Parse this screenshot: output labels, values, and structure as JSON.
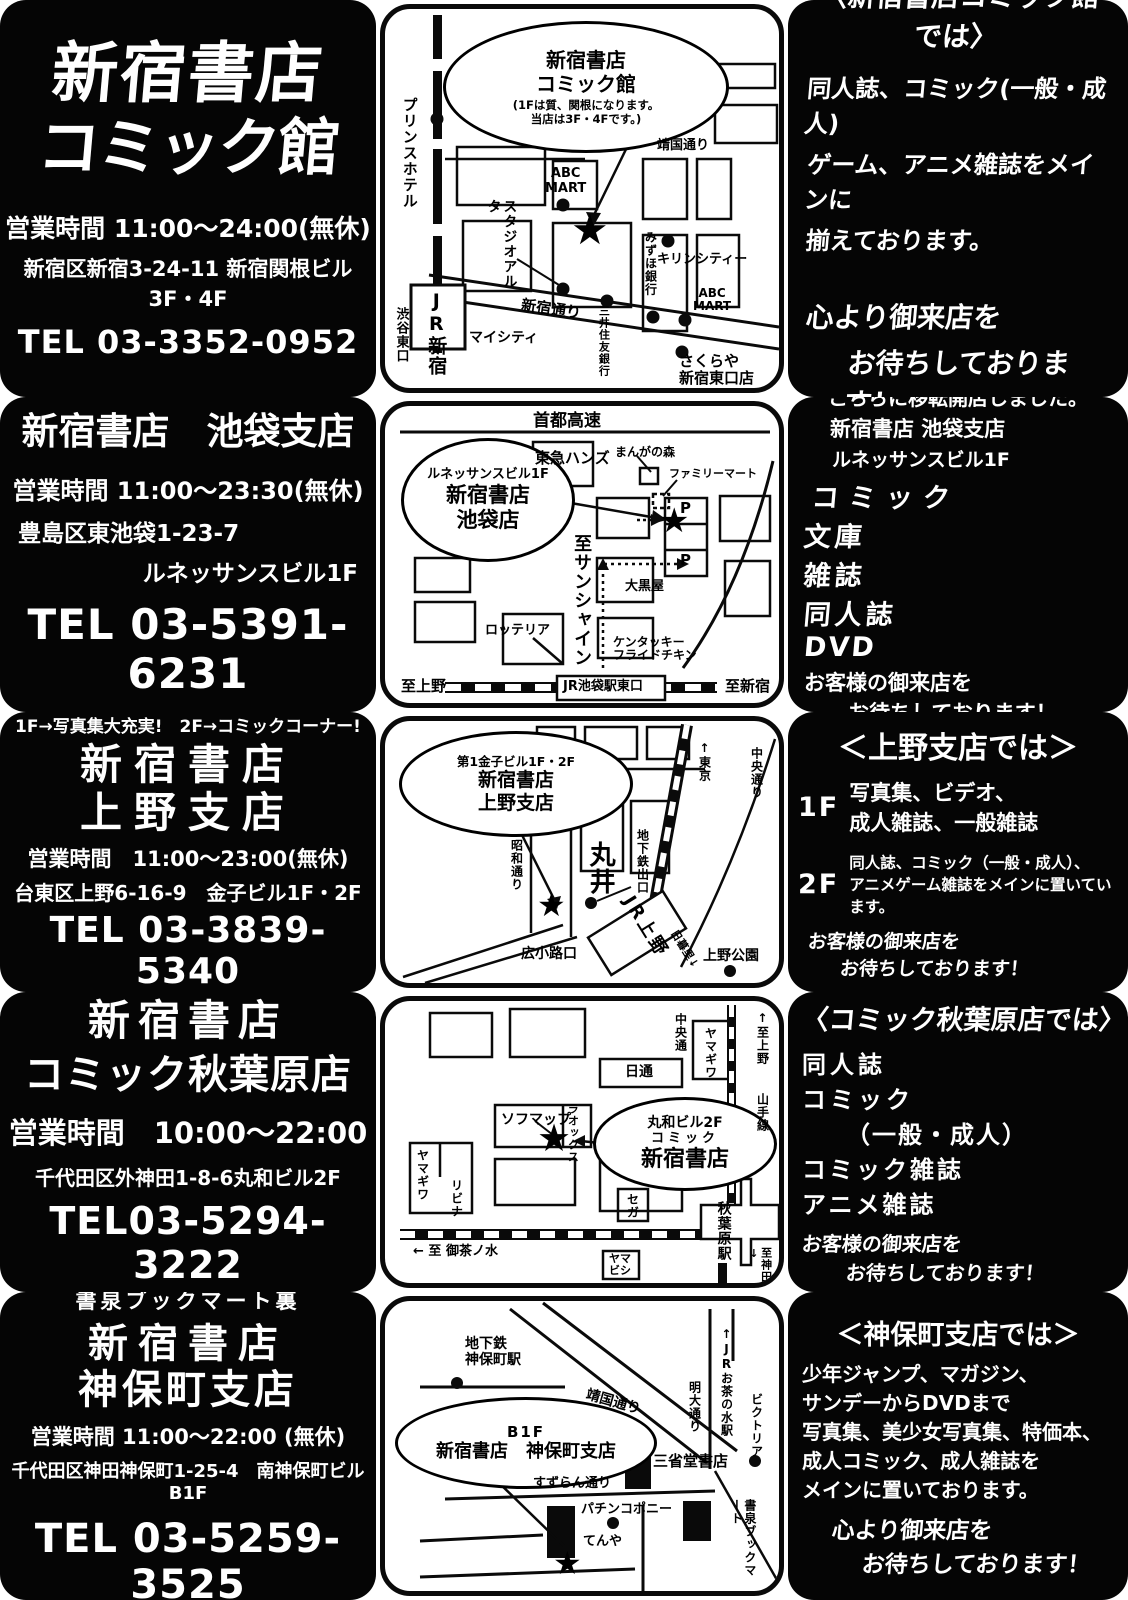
{
  "rows": [
    {
      "store": {
        "line1": "新宿書店",
        "line2": "コミック館",
        "hours": "営業時間 11:00〜24:00(無休)",
        "addr1": "新宿区新宿3-24-11 新宿関根ビル3F・4F",
        "tel": "TEL 03-3352-0952"
      },
      "map": {
        "balloon1": "新宿書店",
        "balloon2": "コミック館",
        "balloon3": "(1Fは質、関根になります。",
        "balloon4": "当店は3F・4Fです。)",
        "prince_hotel": "プリンスホテル",
        "jr_shinjuku": "JR新宿",
        "shibuya_east": "渋谷東口",
        "mycity": "マイシティ",
        "studio_alta": "スタジオアルタ",
        "abc_mart1": "ABC\nMART",
        "shinjuku_dori": "新宿通り",
        "mitsui_sumitomo": "三井住友銀行",
        "mizuho": "みずほ銀行",
        "kirin_city": "キリンシティー",
        "abc_mart2": "ABC\nMART",
        "sakuraya": "さくらや\n新宿東口店",
        "yasukuni_dori": "靖国通り",
        "star": "★"
      },
      "info": {
        "heading": "〈新宿書店コミック館では〉",
        "body1": "同人誌、コミック(一般・成人)",
        "body2": "ゲーム、アニメ雑誌をメインに",
        "body3": "揃えております。",
        "close1": "心より御来店を",
        "close2": "お待ちしております！"
      }
    },
    {
      "store": {
        "line1": "新宿書店　池袋支店",
        "hours": "営業時間 11:00〜23:30(無休)",
        "addr1": "豊島区東池袋1-23-7",
        "addr2": "ルネッサンスビル1F",
        "tel": "TEL 03-5391-6231"
      },
      "map": {
        "shuto": "首都高速",
        "tokyu_hands": "東急ハンズ",
        "manga_mori": "まんがの森",
        "familymart": "ファミリーマート",
        "p_top": "P",
        "p_bottom": "P",
        "balloon1": "ルネッサンスビル1F",
        "balloon2": "新宿書店",
        "balloon3": "池袋店",
        "sunshine": "至サンシャイン",
        "daikokuya": "大黒屋",
        "lotteria": "ロッテリア",
        "kfc": "ケンタッキー\nフライドチキン",
        "to_ueno": "至上野",
        "station": "JR池袋駅東口",
        "to_shinjuku": "至新宿",
        "star": "★"
      },
      "info": {
        "intro1": "こちらに移転開店しました。",
        "intro2": "新宿書店 池袋支店",
        "intro3": "ルネッサンスビル1F",
        "item1": "コミック",
        "item2": "文庫",
        "item3": "雑誌",
        "item4": "同人誌",
        "item5": "DVD",
        "close1": "お客様の御来店を",
        "close2": "お待ちしております！"
      }
    },
    {
      "store": {
        "top": "1F→写真集大充実!　2F→コミックコーナー!",
        "line1": "新宿書店",
        "line2": "上野支店",
        "hours": "営業時間　11:00〜23:00(無休)",
        "addr1": "台東区上野6-16-9　金子ビル1F・2F",
        "tel": "TEL 03-3839-5340"
      },
      "map": {
        "balloon1": "第1金子ビル1F・2F",
        "balloon2": "新宿書店",
        "balloon3": "上野支店",
        "showa_dori": "昭和通り",
        "marui": "丸井",
        "subway_exit": "地下鉄出口",
        "to_tokyo": "↑東京",
        "chuo_dori": "中央通り",
        "hirokoji": "広小路口",
        "jr_ueno": "JR上野",
        "nippori": "日暮里↓",
        "ueno_park": "上野公園",
        "star": "★"
      },
      "info": {
        "heading": "＜上野支店では＞",
        "floor1_label": "1F",
        "floor1_line1": "写真集、ビデオ、",
        "floor1_line2": "成人雑誌、一般雑誌",
        "floor2_label": "2F",
        "floor2_line1": "同人誌、コミック（一般・成人）、",
        "floor2_line2": "アニメゲーム雑誌をメインに置いています。",
        "close1": "お客様の御来店を",
        "close2": "お待ちしております！"
      }
    },
    {
      "store": {
        "line1": "新宿書店",
        "line2": "コミック秋葉原店",
        "hours": "営業時間　10:00〜22:00",
        "addr1": "千代田区外神田1-8-6丸和ビル2F",
        "tel": "TEL03-5294-3222"
      },
      "map": {
        "chuo_dori": "中央通",
        "yamagiwa1": "ヤマギワ",
        "to_ueno": "↑至上野",
        "yamanote": "山手線",
        "nittsu": "日通",
        "sofmap": "ソフマップ",
        "laox": "ラオックス",
        "balloon1": "丸和ビル2F",
        "balloon2": "コミック",
        "balloon3": "新宿書店",
        "yamagiwa2": "ヤマギワ",
        "livina": "リビナ",
        "sega": "セガ",
        "station": "秋葉原駅",
        "ochanomizu": "← 至 御茶ノ水",
        "yamabishi": "ヤマ\nビシ",
        "to_kanda": "至神田↓",
        "star": "★"
      },
      "info": {
        "heading": "〈コミック秋葉原店では〉",
        "body1": "同人誌",
        "body2": "コミック",
        "body3": "（一般・成人）",
        "body4": "コミック雑誌",
        "body5": "アニメ雑誌",
        "close1": "お客様の御来店を",
        "close2": "お待ちしております！"
      }
    },
    {
      "store": {
        "top": "書泉ブックマート裏",
        "line1": "新宿書店",
        "line2": "神保町支店",
        "hours": "営業時間 11:00〜22:00 (無休)",
        "addr1": "千代田区神田神保町1-25-4　南神保町ビルB1F",
        "tel": "TEL 03-5259-3525"
      },
      "map": {
        "subway": "地下鉄\n神保町駅",
        "yasukuni": "靖国通り",
        "balloon1": "B1F",
        "balloon2": "新宿書店　神保町支店",
        "suzuran": "すずらん通り",
        "pachinko": "パチンコポニー",
        "tenya": "てんや",
        "sanseido": "三省堂書店",
        "meidai": "明大通り",
        "jr_ochanomizu": "↑JRお茶の水駅",
        "victoria": "ビクトリア",
        "shosen": "書泉ブックマート",
        "star": "★"
      },
      "info": {
        "heading": "＜神保町支店では＞",
        "body1": "少年ジャンプ、マガジン、",
        "body2": "サンデーからDVDまで",
        "body3": "写真集、美少女写真集、特価本、",
        "body4": "成人コミック、成人雑誌を",
        "body5": "メインに置いております。",
        "close1": "心より御来店を",
        "close2": "お待ちしております！"
      }
    }
  ]
}
